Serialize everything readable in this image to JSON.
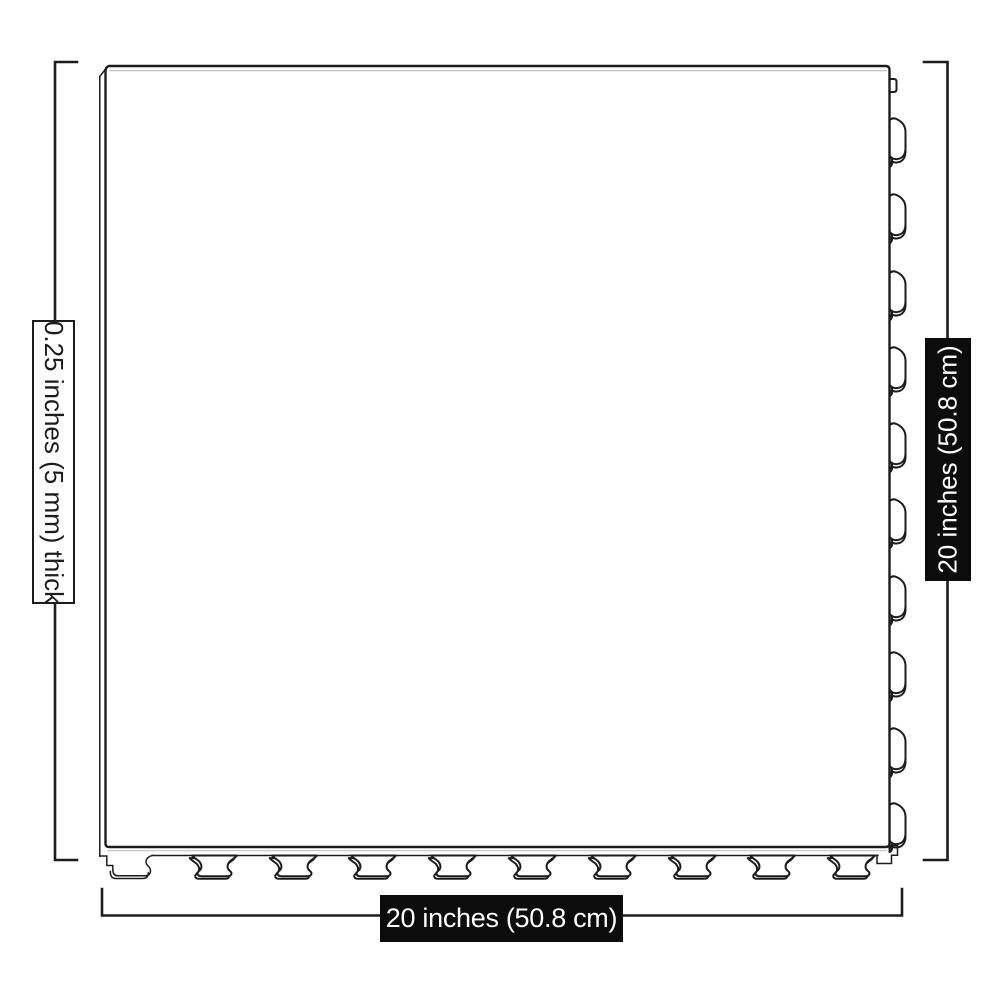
{
  "diagram": {
    "title": "interlocking-floor-tile-dimension-diagram",
    "labels": {
      "thickness": "0.25 inches (5 mm) thick",
      "side_height": "20 inches (50.8 cm)",
      "side_width": "20 inches (50.8 cm)"
    },
    "tile": {
      "right_edge_tab_count": 10,
      "bottom_edge_tab_count": 10,
      "corner_notch": "small square tab at top-right, stepped feet at bottom corners"
    },
    "colors": {
      "background": "#ffffff",
      "line": "#1c1c1c",
      "dark_label_bg": "#0c0c0c",
      "dark_label_text": "#ffffff",
      "light_label_bg": "#ffffff",
      "light_label_text": "#1c1c1c"
    }
  }
}
